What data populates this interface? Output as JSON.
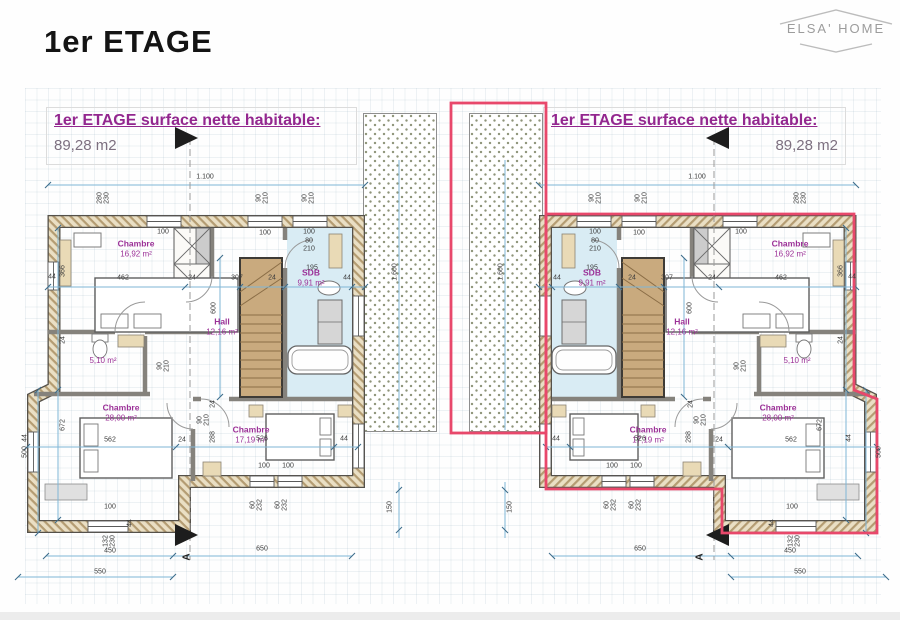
{
  "page": {
    "title": "1er ETAGE",
    "logo": "ELSA' HOME"
  },
  "headers": {
    "left": {
      "title": "1er ETAGE surface nette habitable:",
      "area": "89,28 m2"
    },
    "right": {
      "title": "1er ETAGE surface nette habitable:",
      "area": "89,28 m2"
    }
  },
  "colors": {
    "accent_purple": "#93278f",
    "outline_red": "#e8486b",
    "dim_blue": "#7fb6d6",
    "wall_tan": "#b49c72",
    "stair_brown": "#c9aa7e"
  },
  "plans": {
    "left": {
      "rooms": [
        {
          "n": "Chambre",
          "a": "16,92 m²",
          "x": 136,
          "y": 249
        },
        {
          "n": "SDB",
          "a": "9,91 m²",
          "x": 311,
          "y": 278
        },
        {
          "n": "Hall",
          "a": "12,16 m²",
          "x": 222,
          "y": 327
        },
        {
          "n": "",
          "a": "5,10 m²",
          "x": 103,
          "y": 361
        },
        {
          "n": "Chambre",
          "a": "28,00 m²",
          "x": 121,
          "y": 413
        },
        {
          "n": "Chambre",
          "a": "17,19 m²",
          "x": 251,
          "y": 435
        }
      ],
      "dims": [
        [
          "1.100",
          205,
          177,
          0
        ],
        [
          "44",
          52,
          277,
          0
        ],
        [
          "462",
          123,
          278,
          0
        ],
        [
          "24",
          192,
          278,
          0
        ],
        [
          "307",
          237,
          278,
          0
        ],
        [
          "24",
          272,
          278,
          0
        ],
        [
          "195",
          312,
          268,
          0
        ],
        [
          "44",
          347,
          278,
          0
        ],
        [
          "100",
          163,
          232,
          0
        ],
        [
          "100",
          265,
          233,
          0
        ],
        [
          "100",
          309,
          232,
          0
        ],
        [
          "80",
          309,
          241,
          0
        ],
        [
          "210",
          309,
          249,
          0
        ],
        [
          "280",
          100,
          198,
          1
        ],
        [
          "230",
          107,
          198,
          1
        ],
        [
          "90",
          259,
          198,
          1
        ],
        [
          "210",
          266,
          198,
          1
        ],
        [
          "90",
          305,
          198,
          1
        ],
        [
          "210",
          312,
          198,
          1
        ],
        [
          "366",
          63,
          271,
          1
        ],
        [
          "24",
          63,
          340,
          1
        ],
        [
          "672",
          63,
          425,
          1
        ],
        [
          "44",
          25,
          438,
          1
        ],
        [
          "600",
          214,
          308,
          1
        ],
        [
          "90",
          160,
          366,
          1
        ],
        [
          "210",
          167,
          366,
          1
        ],
        [
          "24",
          213,
          404,
          1
        ],
        [
          "288",
          213,
          437,
          1
        ],
        [
          "90",
          200,
          420,
          1
        ],
        [
          "210",
          207,
          420,
          1
        ],
        [
          "562",
          110,
          440,
          0
        ],
        [
          "24",
          182,
          440,
          0
        ],
        [
          "526",
          262,
          439,
          0
        ],
        [
          "44",
          344,
          439,
          0
        ],
        [
          "100",
          264,
          466,
          0
        ],
        [
          "100",
          288,
          466,
          0
        ],
        [
          "60",
          253,
          505,
          1
        ],
        [
          "232",
          260,
          505,
          1
        ],
        [
          "60",
          278,
          505,
          1
        ],
        [
          "232",
          285,
          505,
          1
        ],
        [
          "100",
          110,
          507,
          0
        ],
        [
          "44",
          130,
          523,
          1
        ],
        [
          "132",
          106,
          541,
          1
        ],
        [
          "230",
          113,
          541,
          1
        ],
        [
          "450",
          110,
          551,
          0
        ],
        [
          "650",
          262,
          549,
          0
        ],
        [
          "550",
          100,
          572,
          0
        ],
        [
          "500",
          25,
          452,
          1
        ],
        [
          "1.600",
          395,
          272,
          1
        ],
        [
          "150",
          390,
          507,
          1
        ]
      ],
      "sections": [
        {
          "t": "A",
          "x": 187,
          "y": 557
        }
      ]
    },
    "right": {
      "rooms": [
        {
          "n": "Chambre",
          "a": "16,92 m²",
          "x": 790,
          "y": 249
        },
        {
          "n": "SDB",
          "a": "9,91 m²",
          "x": 592,
          "y": 278
        },
        {
          "n": "Hall",
          "a": "12,16 m²",
          "x": 682,
          "y": 327
        },
        {
          "n": "",
          "a": "5,10 m²",
          "x": 797,
          "y": 361
        },
        {
          "n": "Chambre",
          "a": "28,00 m²",
          "x": 778,
          "y": 413
        },
        {
          "n": "Chambre",
          "a": "17,19 m²",
          "x": 648,
          "y": 435
        }
      ],
      "dims": [
        [
          "1.100",
          697,
          177,
          0
        ],
        [
          "44",
          852,
          277,
          0
        ],
        [
          "462",
          781,
          278,
          0
        ],
        [
          "24",
          712,
          278,
          0
        ],
        [
          "307",
          667,
          278,
          0
        ],
        [
          "24",
          632,
          278,
          0
        ],
        [
          "195",
          592,
          268,
          0
        ],
        [
          "44",
          557,
          278,
          0
        ],
        [
          "100",
          741,
          232,
          0
        ],
        [
          "100",
          639,
          233,
          0
        ],
        [
          "100",
          595,
          232,
          0
        ],
        [
          "80",
          595,
          241,
          0
        ],
        [
          "210",
          595,
          249,
          0
        ],
        [
          "280",
          797,
          198,
          1
        ],
        [
          "230",
          804,
          198,
          1
        ],
        [
          "90",
          638,
          198,
          1
        ],
        [
          "210",
          645,
          198,
          1
        ],
        [
          "90",
          592,
          198,
          1
        ],
        [
          "210",
          599,
          198,
          1
        ],
        [
          "366",
          841,
          271,
          1
        ],
        [
          "24",
          841,
          340,
          1
        ],
        [
          "672",
          820,
          425,
          1
        ],
        [
          "44",
          849,
          438,
          1
        ],
        [
          "600",
          690,
          308,
          1
        ],
        [
          "90",
          737,
          366,
          1
        ],
        [
          "210",
          744,
          366,
          1
        ],
        [
          "24",
          691,
          404,
          1
        ],
        [
          "288",
          689,
          437,
          1
        ],
        [
          "90",
          697,
          420,
          1
        ],
        [
          "210",
          704,
          420,
          1
        ],
        [
          "562",
          791,
          440,
          0
        ],
        [
          "24",
          719,
          440,
          0
        ],
        [
          "526",
          640,
          439,
          0
        ],
        [
          "44",
          556,
          439,
          0
        ],
        [
          "100",
          612,
          466,
          0
        ],
        [
          "100",
          636,
          466,
          0
        ],
        [
          "60",
          607,
          505,
          1
        ],
        [
          "232",
          614,
          505,
          1
        ],
        [
          "60",
          632,
          505,
          1
        ],
        [
          "232",
          639,
          505,
          1
        ],
        [
          "100",
          792,
          507,
          0
        ],
        [
          "44",
          772,
          523,
          1
        ],
        [
          "132",
          791,
          541,
          1
        ],
        [
          "230",
          798,
          541,
          1
        ],
        [
          "450",
          790,
          551,
          0
        ],
        [
          "650",
          640,
          549,
          0
        ],
        [
          "550",
          800,
          572,
          0
        ],
        [
          "500",
          879,
          452,
          1
        ],
        [
          "1.600",
          501,
          272,
          1
        ],
        [
          "150",
          510,
          507,
          1
        ]
      ],
      "sections": [
        {
          "t": "A",
          "x": 700,
          "y": 557
        }
      ]
    }
  }
}
